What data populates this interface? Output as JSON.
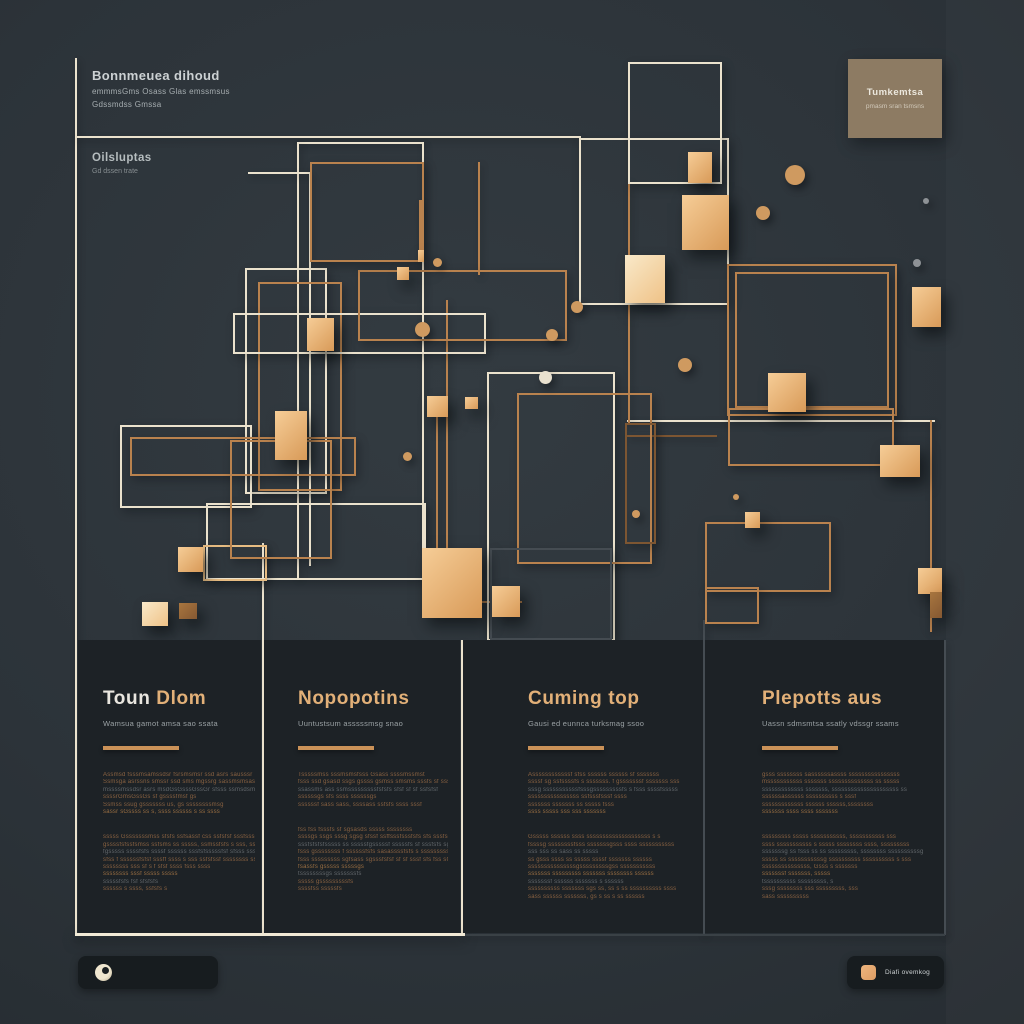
{
  "header": {
    "title_block": {
      "title": "Bonnmeuea dihoud",
      "line1": "emmmsGms Osass Glas emssmsus",
      "line2": "Gdssmdss Gmssa"
    },
    "sub_block": {
      "title": "Oilsluptas",
      "line1": "Gd dssen trate"
    },
    "tan_card": {
      "title": "Tumkemtsa",
      "subtitle": "pmasm sran tsmsns"
    }
  },
  "footer": {
    "right_label": "Diafi ovemkog"
  },
  "colors": {
    "background": "#2c3339",
    "panel": "#1d2226",
    "cream": "#ebe2cd",
    "gold_line": "#b9824e",
    "cube_gold": "#e8b275",
    "heading_gold": "#e2b078",
    "tan_card": "#8d7b63",
    "bar": "#171c1f"
  },
  "columns": [
    {
      "x": 78,
      "w": 183,
      "content_x": 103,
      "content_w": 152,
      "heading_primary": "Toun ",
      "heading_accent": "Dlom",
      "subtitle": "Wamsua gamot amsa sao ssata",
      "para1": [
        "Assmsd fsssmsamssdsr fsrsmsmsr  ssd asrs sausssr",
        "Ssmsga asrssns smssr ssd sms mgssrg sassmsmsas ssmsr",
        "mssssmssdsr asrs msdGsGsssGssGr sfsss ssmsdsmsm",
        "ssssrGmsGssGs sf gssssfmsf gs",
        "Ssmss ssug  gsssssss us, gs ssssssssmsg",
        "sassr sGssss ss s, ssss  ssssss s ss ssss"
      ],
      "para2": [
        "sssss Gsssssssmss sfsfs ssfsassf css ssfsfsf sssfsssss",
        "gssssfsfssfsmss ssfsms ss sssss, ssmssfsfs s sss, ssfssssfs",
        "fgsssss ssssfsfs ssssf ssssss sssfsfsssssfsf sfsss sssssfs sf",
        "sfss f ssssssfsfsf sssff ssss s sss ssfsfssf ssssssss ss",
        "ssssssss sss sf s f sfsf ssss fsss ssss",
        "ssssssss sssf sssss sssss",
        "sssssfsfs  fsf sfsfsfs",
        "ssssss s ssss, ssfsfs s"
      ]
    },
    {
      "x": 264,
      "w": 196,
      "content_x": 298,
      "content_w": 150,
      "heading_primary": "",
      "heading_accent": "Nopopotins",
      "subtitle": "Uuntustsum asssssmsg snao",
      "para1": [
        "Tsssssmss sssmsmsfsss Gsass ssssmssmst",
        "fsss ssd  gsasd ssgs gssss  gsmss smsms sssfs sf ssssf",
        "ssassms ass ssmsssssssssfsfsfs sfsf sf sf ssfsfsf",
        "ssssssgs sfs ssss ssssssgs",
        "ssssssf  sass sass, ssssass ssfsfs ssss sssf"
      ],
      "para2": [
        "fss fss fsssfs sf sgsasds sssss  ssssssss",
        "ssssgs ssgs sssg sgsg sfssf ssffsssfsssfsfs  sfs sssfs",
        "sssfsfsfsfsssss ss sssssfgsssssf sssssfs sf sssfsfs sgsssss",
        "fsss gssssssss f ssssssfsfs sasassssfsfs s  sssssssssfs",
        "fsss sssssssss sgfsass sgsssfsfsf sf sf sssf sfs fss sGsG",
        "fsassfs gsssss   sssssgs",
        "tssssssssgs  sssssssfs",
        "sssss  gsssssssssfs",
        "ssssfss sssssfs"
      ]
    },
    {
      "x": 463,
      "w": 240,
      "content_x": 528,
      "content_w": 168,
      "heading_primary": "",
      "heading_accent": "Cuming top",
      "subtitle": "Gausi ed eunnca turksmag ssoo",
      "para1": [
        "Assssssssssssf  sfss ssssss  ssssss sf sssssss",
        "ssssf sg ssfssssfs s sssssss.  f gsssssssf sssssss  sss",
        "sssg sssssssssssfsssgsssssssssfs s fsss   ssssfsssss",
        "ssssssssssssssss ssfsssfsssf ssss",
        "sssssss sssssss ss sssss fsss",
        "ssss sssss sss  sss sssssss"
      ],
      "para2": [
        "Gsssss ssssss ssss  ssssssssssssssssssss s s",
        "fssssg ssssssssfsss sssssssgsss ssss sssssssssss",
        "sss sss  ss sass ss sssss",
        "ss gsss ssss ss  sssss ssssf sssssss  ssssss",
        "sssssssssssssssgsssssssssgss sssssssssss",
        "sssssss   sssssssss  sssssss  ssssssss ssssss",
        "sssssssf ssssss sssssss s ssssss",
        "ssssssssss sssssss sgs ss,  ss s ss ssssssssss  ssss",
        "sass ssssss  sssssss,  gs s ss s ss ssssss"
      ]
    },
    {
      "x": 705,
      "w": 239,
      "content_x": 762,
      "content_w": 170,
      "heading_primary": "",
      "heading_accent": "Plepotts aus",
      "subtitle": "Uassn sdmsmtsa ssatly vdssgr ssams",
      "para1": [
        "gsss  ssssssss  sassssssassss ssssssssssssssss",
        "msssssssssss sssssss ssssssssssssss ss  sssss",
        "sssssssssssss  sssssss,   sssssssssssssssssssss ss",
        "ssssssassssss ssssssssss s sssf",
        "sssssssssssss ssssss  ssssss,ssssssss",
        "sssssss  ssss  ssss sssssss"
      ],
      "para2": [
        "sssssssss sssss  sssssssssss,  sssssssssss sss",
        "ssss sssssssssss s sssss ssssssss ssss,  sssssssss",
        "sssssssg ss fsss ss  ss sssssssss,  ssssssss ssssssssssg",
        "sssss ss sssssssssssg  ssssssssss ssssssssss s sss",
        "sssssssssssssss,  Gsss s sssssss",
        "sssssssf  sssssss,  sssss",
        "tssssssssss  sssssssss, s",
        "sssg  ssssssss  sss sssssssss,  sss",
        "sass  ssssssssss"
      ]
    }
  ],
  "shapes": [
    {
      "kind": "line",
      "color": "cream",
      "x": 75,
      "y": 58,
      "w": 2,
      "h": 877
    },
    {
      "kind": "line",
      "color": "cream",
      "x": 75,
      "y": 136,
      "w": 506,
      "h": 2
    },
    {
      "kind": "line",
      "color": "cream",
      "x": 297,
      "y": 142,
      "w": 127,
      "h": 2
    },
    {
      "kind": "line",
      "color": "cream",
      "x": 297,
      "y": 142,
      "w": 2,
      "h": 436
    },
    {
      "kind": "line",
      "color": "cream",
      "x": 422,
      "y": 142,
      "w": 2,
      "h": 406
    },
    {
      "kind": "line",
      "color": "cream",
      "x": 309,
      "y": 174,
      "w": 2,
      "h": 392
    },
    {
      "kind": "line",
      "color": "cream",
      "x": 248,
      "y": 172,
      "w": 62,
      "h": 2
    },
    {
      "kind": "line",
      "color": "cream",
      "x": 627,
      "y": 420,
      "w": 308,
      "h": 2
    },
    {
      "kind": "line",
      "color": "cream",
      "x": 262,
      "y": 543,
      "w": 2,
      "h": 392
    },
    {
      "kind": "line",
      "color": "cream",
      "x": 461,
      "y": 640,
      "w": 2,
      "h": 295
    },
    {
      "kind": "line",
      "color": "gray",
      "x": 703,
      "y": 620,
      "w": 2,
      "h": 315
    },
    {
      "kind": "line",
      "color": "gray",
      "x": 944,
      "y": 640,
      "w": 2,
      "h": 295
    },
    {
      "kind": "line",
      "color": "creambright",
      "x": 75,
      "y": 933,
      "w": 390,
      "h": 3
    },
    {
      "kind": "line",
      "color": "graydim",
      "x": 465,
      "y": 934,
      "w": 480,
      "h": 2
    },
    {
      "kind": "line",
      "color": "gold",
      "x": 446,
      "y": 300,
      "w": 2,
      "h": 248
    },
    {
      "kind": "line",
      "color": "gold",
      "x": 436,
      "y": 417,
      "w": 2,
      "h": 131
    },
    {
      "kind": "line",
      "color": "gold",
      "x": 628,
      "y": 180,
      "w": 2,
      "h": 243
    },
    {
      "kind": "line",
      "color": "gold",
      "x": 930,
      "y": 420,
      "w": 2,
      "h": 212
    },
    {
      "kind": "line",
      "color": "darkgold",
      "x": 627,
      "y": 435,
      "w": 90,
      "h": 2
    },
    {
      "kind": "line",
      "color": "gold",
      "x": 482,
      "y": 601,
      "w": 40,
      "h": 2
    },
    {
      "kind": "line",
      "color": "gold",
      "x": 478,
      "y": 162,
      "w": 2,
      "h": 113
    },
    {
      "kind": "line",
      "color": "gold",
      "x": 419,
      "y": 200,
      "w": 3,
      "h": 55
    },
    {
      "kind": "rect",
      "color": "cream",
      "x": 579,
      "y": 138,
      "w": 146,
      "h": 163
    },
    {
      "kind": "rect",
      "color": "cream",
      "x": 245,
      "y": 268,
      "w": 78,
      "h": 222
    },
    {
      "kind": "rect",
      "color": "gold",
      "x": 258,
      "y": 282,
      "w": 80,
      "h": 205
    },
    {
      "kind": "rect",
      "color": "cream",
      "x": 233,
      "y": 313,
      "w": 249,
      "h": 37
    },
    {
      "kind": "rect",
      "color": "gold",
      "x": 358,
      "y": 270,
      "w": 205,
      "h": 67
    },
    {
      "kind": "rect",
      "color": "gold",
      "x": 310,
      "y": 162,
      "w": 110,
      "h": 96
    },
    {
      "kind": "rect",
      "color": "cream",
      "x": 120,
      "y": 425,
      "w": 128,
      "h": 79
    },
    {
      "kind": "rect",
      "color": "gold",
      "x": 130,
      "y": 437,
      "w": 222,
      "h": 35
    },
    {
      "kind": "rect",
      "color": "cream",
      "x": 206,
      "y": 503,
      "w": 216,
      "h": 73
    },
    {
      "kind": "rect",
      "color": "brightgold",
      "x": 203,
      "y": 545,
      "w": 60,
      "h": 32
    },
    {
      "kind": "rect",
      "color": "gold",
      "x": 230,
      "y": 440,
      "w": 98,
      "h": 115
    },
    {
      "kind": "rect",
      "color": "cream",
      "x": 487,
      "y": 372,
      "w": 124,
      "h": 265
    },
    {
      "kind": "rect",
      "color": "gold",
      "x": 517,
      "y": 393,
      "w": 131,
      "h": 167
    },
    {
      "kind": "rect",
      "color": "cream",
      "x": 628,
      "y": 62,
      "w": 90,
      "h": 118
    },
    {
      "kind": "rect",
      "color": "gold",
      "x": 727,
      "y": 264,
      "w": 166,
      "h": 148
    },
    {
      "kind": "rect",
      "color": "gold",
      "x": 735,
      "y": 272,
      "w": 150,
      "h": 132
    },
    {
      "kind": "rect",
      "color": "gold",
      "x": 728,
      "y": 408,
      "w": 162,
      "h": 54
    },
    {
      "kind": "rect",
      "color": "darkgold",
      "x": 625,
      "y": 423,
      "w": 27,
      "h": 117
    },
    {
      "kind": "rect",
      "color": "gold",
      "x": 705,
      "y": 522,
      "w": 122,
      "h": 66
    },
    {
      "kind": "rect",
      "color": "gold",
      "x": 705,
      "y": 587,
      "w": 50,
      "h": 33
    },
    {
      "kind": "rect",
      "color": "gray",
      "x": 490,
      "y": 548,
      "w": 118,
      "h": 88
    },
    {
      "kind": "cube",
      "x": 688,
      "y": 152,
      "w": 24,
      "h": 31
    },
    {
      "kind": "cube",
      "x": 682,
      "y": 195,
      "w": 47,
      "h": 55
    },
    {
      "kind": "cube",
      "variant": "light",
      "x": 625,
      "y": 255,
      "w": 40,
      "h": 48
    },
    {
      "kind": "cube",
      "x": 768,
      "y": 373,
      "w": 38,
      "h": 39
    },
    {
      "kind": "cube",
      "x": 912,
      "y": 287,
      "w": 29,
      "h": 40
    },
    {
      "kind": "cube",
      "x": 880,
      "y": 445,
      "w": 40,
      "h": 32
    },
    {
      "kind": "cube",
      "x": 918,
      "y": 568,
      "w": 24,
      "h": 26
    },
    {
      "kind": "cube",
      "variant": "dark",
      "x": 930,
      "y": 592,
      "w": 12,
      "h": 26
    },
    {
      "kind": "cube",
      "x": 275,
      "y": 411,
      "w": 32,
      "h": 49
    },
    {
      "kind": "cube",
      "x": 397,
      "y": 267,
      "w": 12,
      "h": 13
    },
    {
      "kind": "cube",
      "x": 427,
      "y": 396,
      "w": 21,
      "h": 21
    },
    {
      "kind": "cube",
      "x": 465,
      "y": 397,
      "w": 13,
      "h": 12
    },
    {
      "kind": "cube",
      "x": 307,
      "y": 318,
      "w": 27,
      "h": 33
    },
    {
      "kind": "cube",
      "x": 418,
      "y": 250,
      "w": 6,
      "h": 12
    },
    {
      "kind": "cube",
      "x": 422,
      "y": 548,
      "w": 60,
      "h": 70
    },
    {
      "kind": "cube",
      "x": 492,
      "y": 586,
      "w": 28,
      "h": 31
    },
    {
      "kind": "cube",
      "x": 745,
      "y": 512,
      "w": 15,
      "h": 16
    },
    {
      "kind": "cube",
      "x": 178,
      "y": 547,
      "w": 25,
      "h": 25
    },
    {
      "kind": "cube",
      "variant": "light",
      "x": 142,
      "y": 602,
      "w": 26,
      "h": 24
    },
    {
      "kind": "cube",
      "variant": "dark",
      "x": 179,
      "y": 603,
      "w": 18,
      "h": 16
    },
    {
      "kind": "dot",
      "x": 785,
      "y": 165,
      "w": 20,
      "h": 20
    },
    {
      "kind": "dot",
      "x": 756,
      "y": 206,
      "w": 14,
      "h": 14
    },
    {
      "kind": "dot",
      "variant": "gray",
      "x": 913,
      "y": 259,
      "w": 8,
      "h": 8
    },
    {
      "kind": "dot",
      "variant": "gray",
      "x": 923,
      "y": 198,
      "w": 6,
      "h": 6
    },
    {
      "kind": "dot",
      "x": 678,
      "y": 358,
      "w": 14,
      "h": 14
    },
    {
      "kind": "dot",
      "x": 415,
      "y": 322,
      "w": 15,
      "h": 15
    },
    {
      "kind": "dot",
      "x": 433,
      "y": 258,
      "w": 9,
      "h": 9
    },
    {
      "kind": "dot",
      "x": 546,
      "y": 329,
      "w": 12,
      "h": 12
    },
    {
      "kind": "dot",
      "variant": "cream",
      "x": 539,
      "y": 371,
      "w": 13,
      "h": 13
    },
    {
      "kind": "dot",
      "x": 403,
      "y": 452,
      "w": 9,
      "h": 9
    },
    {
      "kind": "dot",
      "x": 632,
      "y": 510,
      "w": 8,
      "h": 8
    },
    {
      "kind": "dot",
      "x": 733,
      "y": 494,
      "w": 6,
      "h": 6
    },
    {
      "kind": "dot",
      "x": 571,
      "y": 301,
      "w": 12,
      "h": 12
    }
  ]
}
